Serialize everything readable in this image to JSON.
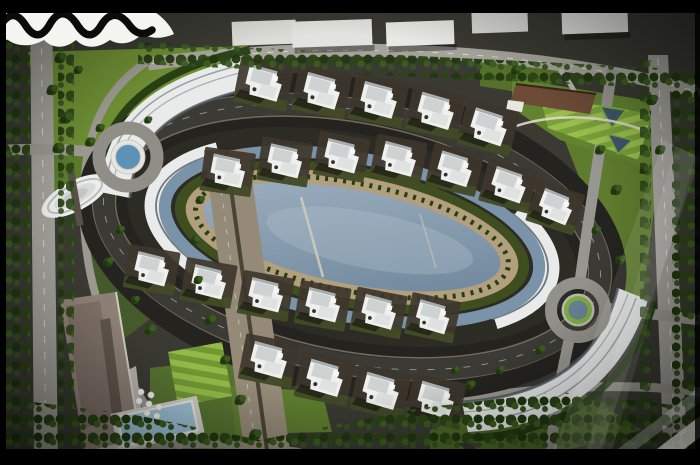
{
  "frame": {
    "top_bar_color": "#000000",
    "bottom_bar_color": "#000000",
    "side_border_color": "#000000"
  },
  "watermark": {
    "name": "wave-signature-logo",
    "position": "top-left",
    "band_color": "#f4f4f1",
    "wave_color": "#0b0b0a"
  },
  "corner_mark": {
    "name": "diagonal-corner-watermark",
    "position": "bottom-right",
    "light_color": "#8c8c88",
    "dark_color": "#2f2f2e"
  },
  "scene": {
    "type": "aerial-3d-render",
    "subject": "Top-down 3D render of an oval gated residential compound with villas around a central lagoon",
    "villa_count": 22,
    "roundabout_count": 2,
    "crescent_building_count": 4,
    "umbrella_count": 7,
    "features": [
      "central-lagoon",
      "ring-canal",
      "oval-ring-road",
      "villa-rows",
      "west-crescent-apartments",
      "east-crescent-apartments",
      "entrance-roundabout-pool",
      "east-roundabout",
      "gate-pavilion-oval",
      "clubhouse",
      "striped-lawns",
      "triangular-ponds",
      "commercial-building",
      "swimming-pool",
      "pool-umbrellas",
      "perimeter-roads",
      "street-trees",
      "offsite-buildings",
      "lens-flare"
    ]
  },
  "colors": {
    "lagoon_light": "#9fb2c2",
    "lagoon_dark": "#6c8499",
    "canal": "#7b93a8",
    "pool_blue": "#5d92b6",
    "pool_light": "#9cc0d4",
    "roundabout_green": "#7cab3e",
    "roundabout_water": "#667f92",
    "pond_dark": "#3f566b",
    "grass_bright": "#6d8d33",
    "grass_mid": "#55702a",
    "grass_dark": "#3c5220",
    "lawn_stripe_light": "#9dc14e",
    "lawn_stripe_dark": "#7aa23a",
    "road_light": "#a2a099",
    "road_mid": "#8e8c84",
    "asphalt_dark": "#3b3a35",
    "ground_dark": "#24231f",
    "villa_white": "#eef0ee",
    "roof_gray": "#ced2d2",
    "promenade": "#b19f7e",
    "boulevard": "#958a78",
    "crescent_white": "#e9ebea",
    "clubhouse_brown": "#6d4b37",
    "commercial_mauve": "#8d7f75",
    "tree_dark": "#20380e",
    "tree_mid": "#2b4416",
    "tree_light": "#3b5c20"
  }
}
